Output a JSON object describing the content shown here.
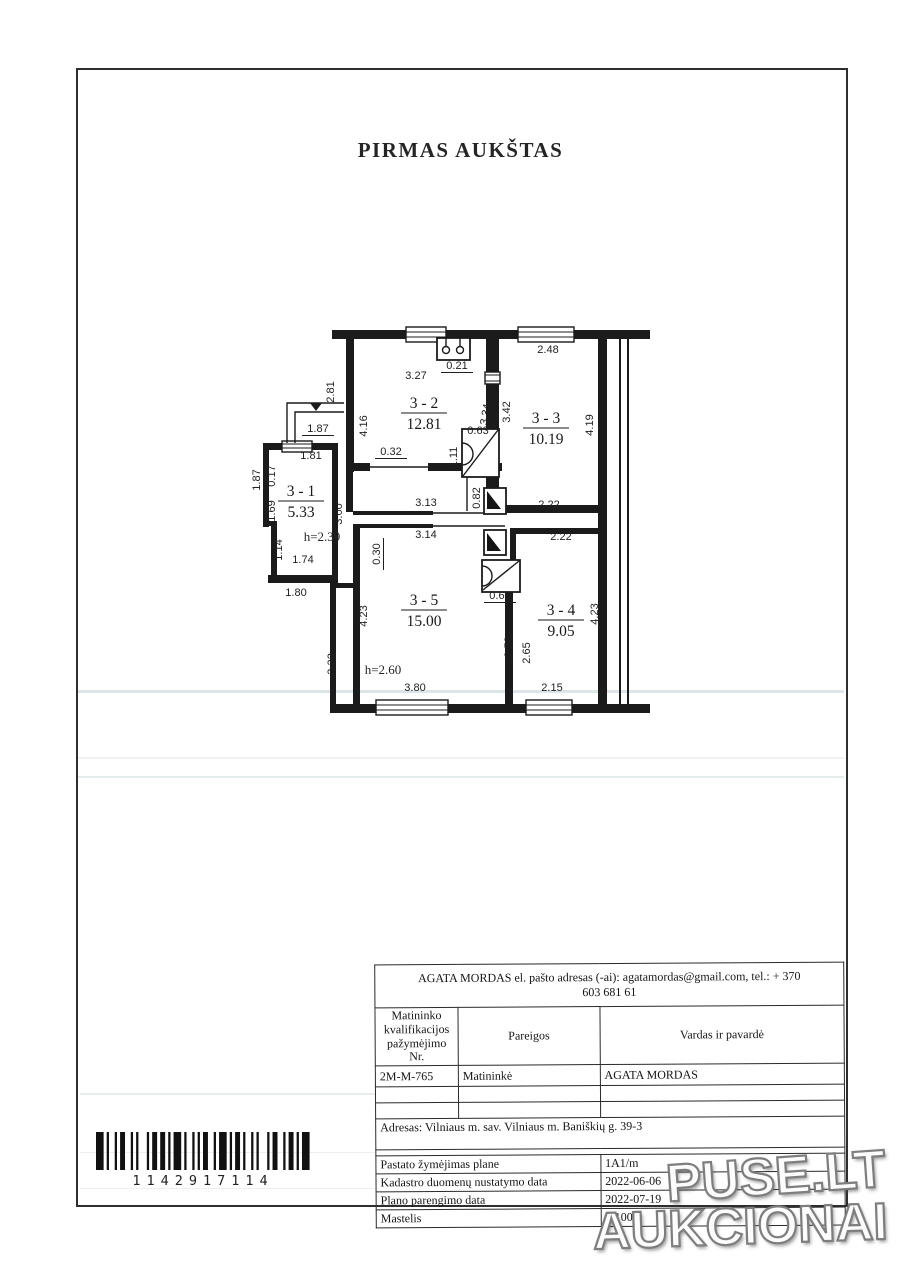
{
  "page": {
    "title": "PIRMAS AUKŠTAS"
  },
  "watermark": {
    "line1": "PUSE.LT",
    "line2": "AUKCIONAI"
  },
  "barcode": {
    "digits": "1142917114"
  },
  "floor_plan": {
    "rooms": [
      {
        "id": "3 - 1",
        "area": "5.33",
        "x": 301,
        "y": 496,
        "note": "h=2.39",
        "nx": 322,
        "ny": 541
      },
      {
        "id": "3 - 2",
        "area": "12.81",
        "x": 424,
        "y": 408
      },
      {
        "id": "3 - 3",
        "area": "10.19",
        "x": 546,
        "y": 423
      },
      {
        "id": "3 - 4",
        "area": "9.05",
        "x": 561,
        "y": 615
      },
      {
        "id": "3 - 5",
        "area": "15.00",
        "x": 424,
        "y": 605,
        "note": "h=2.60",
        "nx": 383,
        "ny": 674
      }
    ],
    "dims": [
      {
        "v": "2.81",
        "x": 334,
        "y": 392,
        "r": -90
      },
      {
        "v": "1.87",
        "x": 318,
        "y": 432,
        "u": 1
      },
      {
        "v": "1.81",
        "x": 311,
        "y": 459
      },
      {
        "v": "1.87",
        "x": 260,
        "y": 480,
        "r": -90
      },
      {
        "v": "0.17",
        "x": 275,
        "y": 476,
        "r": -90
      },
      {
        "v": "1.69",
        "x": 275,
        "y": 511,
        "r": -90
      },
      {
        "v": "1.14",
        "x": 282,
        "y": 550,
        "r": -90
      },
      {
        "v": "1.74",
        "x": 303,
        "y": 563
      },
      {
        "v": "1.80",
        "x": 296,
        "y": 596
      },
      {
        "v": "3.00",
        "x": 342,
        "y": 514,
        "r": -90
      },
      {
        "v": "4.16",
        "x": 367,
        "y": 426,
        "r": -90
      },
      {
        "v": "0.32",
        "x": 391,
        "y": 455,
        "u": 1
      },
      {
        "v": "3.27",
        "x": 416,
        "y": 379
      },
      {
        "v": "0.21",
        "x": 457,
        "y": 369,
        "u": 1
      },
      {
        "v": "3.34",
        "x": 489,
        "y": 415,
        "r": -80
      },
      {
        "v": "3.42",
        "x": 510,
        "y": 412,
        "r": -90
      },
      {
        "v": "0.63",
        "x": 478,
        "y": 434
      },
      {
        "v": "1.11",
        "x": 457,
        "y": 457,
        "r": -90
      },
      {
        "v": "2.48",
        "x": 548,
        "y": 353
      },
      {
        "v": "4.19",
        "x": 593,
        "y": 425,
        "r": -90
      },
      {
        "v": "2.22",
        "x": 549,
        "y": 508
      },
      {
        "v": "3.13",
        "x": 426,
        "y": 506
      },
      {
        "v": "3.14",
        "x": 426,
        "y": 538
      },
      {
        "v": "0.30",
        "x": 380,
        "y": 554,
        "r": -90,
        "u": 1
      },
      {
        "v": "0.82",
        "x": 480,
        "y": 498,
        "r": -90
      },
      {
        "v": "2.22",
        "x": 561,
        "y": 540
      },
      {
        "v": "0.65",
        "x": 500,
        "y": 599,
        "u": 1
      },
      {
        "v": "2.58",
        "x": 512,
        "y": 647,
        "r": -90
      },
      {
        "v": "2.65",
        "x": 530,
        "y": 653,
        "r": -90
      },
      {
        "v": "4.23",
        "x": 367,
        "y": 616,
        "r": -90
      },
      {
        "v": "4.23",
        "x": 598,
        "y": 614,
        "r": -90
      },
      {
        "v": "3.80",
        "x": 415,
        "y": 691
      },
      {
        "v": "2.15",
        "x": 552,
        "y": 691
      },
      {
        "v": "3.32",
        "x": 335,
        "y": 664,
        "r": -90
      }
    ]
  },
  "table": {
    "contact_line1": "AGATA MORDAS el. pašto adresas (-ai): agatamordas@gmail.com, tel.: + 370",
    "contact_line2": "603 681 61",
    "header": {
      "col1": "Matininko kvalifikacijos pažymėjimo Nr.",
      "col2": "Pareigos",
      "col3": "Vardas ir pavardė"
    },
    "surveyor": {
      "cert_no": "2M-M-765",
      "position": "Matininkė",
      "name": "AGATA MORDAS"
    },
    "address": "Adresas: Vilniaus m. sav. Vilniaus m. Baniškių g. 39-3",
    "rows": [
      {
        "label": "Pastato žymėjimas plane",
        "value": "1A1/m"
      },
      {
        "label": "Kadastro duomenų nustatymo data",
        "value": "2022-06-06"
      },
      {
        "label": "Plano parengimo data",
        "value": "2022-07-19"
      },
      {
        "label": "Mastelis",
        "value": "1:100"
      }
    ]
  }
}
